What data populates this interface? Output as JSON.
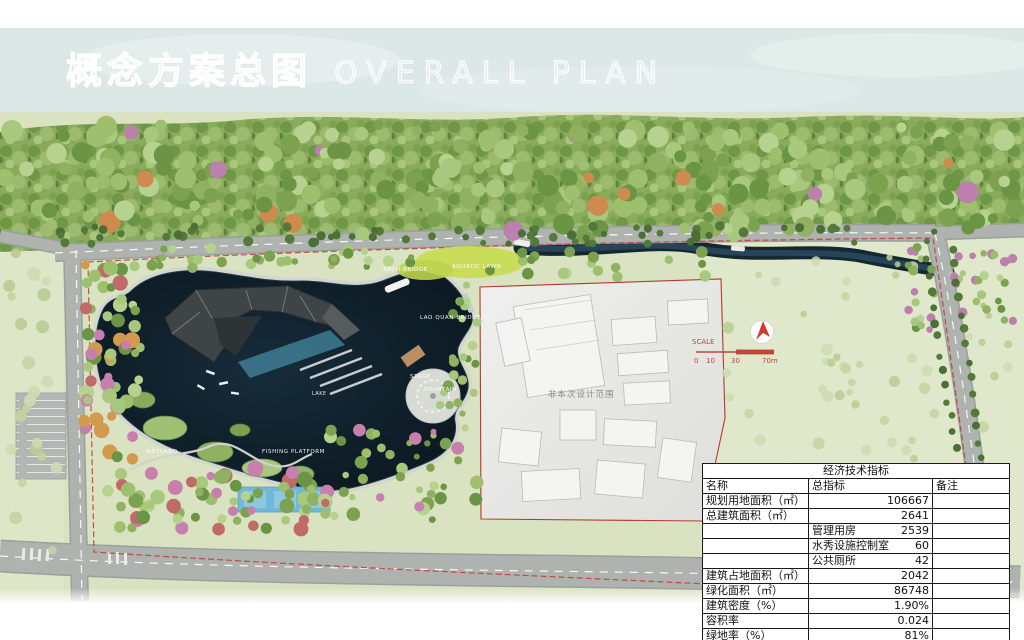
{
  "page": {
    "title_zh": "概念方案总图",
    "title_en": "OVERALL PLAN"
  },
  "map": {
    "labels": {
      "arch_bridge": "ARCH BRIDGE",
      "aquatic_lawn": "AQUATIC LAWN",
      "lao_quan_bridge": "LAO QUAN BRIDGE",
      "stage": "STAGE",
      "fountain": "FOUNTAIN",
      "lake": "LAKE",
      "fishing_platform": "FISHING PLATFORM",
      "wetland": "WETLAND"
    },
    "scope_note": "非本次设计范围",
    "north_arrow_icon": "north-arrow",
    "scale": {
      "label": "SCALE",
      "t0": "0",
      "t1": "10",
      "t2": "30",
      "t3": "70m"
    }
  },
  "table": {
    "title": "经济技术指标",
    "columns": [
      "名称",
      "总指标",
      "备注"
    ],
    "rows": [
      {
        "name": "规划用地面积（㎡）",
        "sub": "",
        "value": "106667",
        "note": ""
      },
      {
        "name": "总建筑面积（㎡）",
        "sub": "",
        "value": "2641",
        "note": ""
      },
      {
        "name": "",
        "sub": "管理用房",
        "value": "2539",
        "note": ""
      },
      {
        "name": "",
        "sub": "水秀设施控制室",
        "value": "60",
        "note": ""
      },
      {
        "name": "",
        "sub": "公共厕所",
        "value": "42",
        "note": ""
      },
      {
        "name": "建筑占地面积（㎡）",
        "sub": "",
        "value": "2042",
        "note": ""
      },
      {
        "name": "绿化面积（㎡）",
        "sub": "",
        "value": "86748",
        "note": ""
      },
      {
        "name": "建筑密度（%）",
        "sub": "",
        "value": "1.90%",
        "note": ""
      },
      {
        "name": "容积率",
        "sub": "",
        "value": "0.024",
        "note": ""
      },
      {
        "name": "绿地率（%）",
        "sub": "",
        "value": "81%",
        "note": ""
      }
    ]
  },
  "colors": {
    "boundary_red": "#b23a2f",
    "scale_red": "#c0443a",
    "lake_dark": "#101f2a",
    "sky": "#dce8e6",
    "field_pale": "#d9e3c2"
  }
}
